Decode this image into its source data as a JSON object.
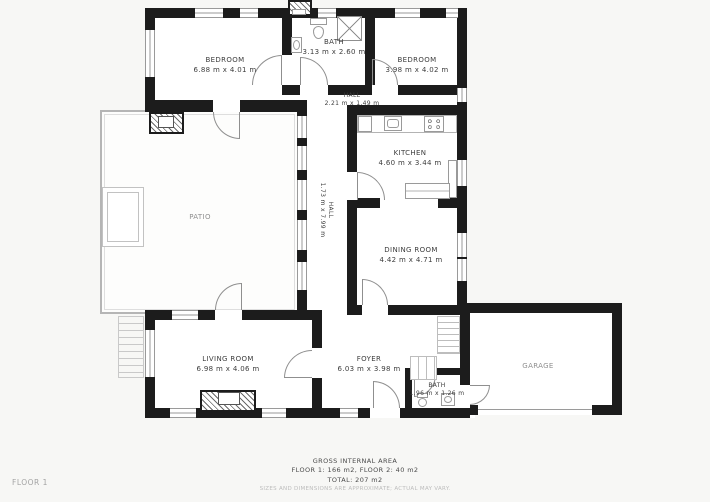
{
  "floor_label": "FLOOR 1",
  "rooms": {
    "bedroom1": {
      "name": "BEDROOM",
      "dims": "6.88 m x 4.01 m"
    },
    "bath1": {
      "name": "BATH",
      "dims": "3.13 m x 2.60 m"
    },
    "bedroom2": {
      "name": "BEDROOM",
      "dims": "3.98 m x 4.02 m"
    },
    "hall_top": {
      "name": "HALL",
      "dims": "2.21 m x 1.49 m"
    },
    "hall_corridor": {
      "name": "HALL",
      "dims": "1.73 m x 7.99 m"
    },
    "kitchen": {
      "name": "KITCHEN",
      "dims": "4.60 m x 3.44 m"
    },
    "patio": {
      "name": "PATIO"
    },
    "dining": {
      "name": "DINING ROOM",
      "dims": "4.42 m x 4.71 m"
    },
    "living": {
      "name": "LIVING ROOM",
      "dims": "6.98 m x 4.06 m"
    },
    "foyer": {
      "name": "FOYER",
      "dims": "6.03 m x 3.98 m"
    },
    "bath2": {
      "name": "BATH",
      "dims": "1.96 m x 1.26 m"
    },
    "garage": {
      "name": "GARAGE"
    }
  },
  "footer": {
    "title": "GROSS INTERNAL AREA",
    "floors": "FLOOR 1: 166 m2, FLOOR 2: 40 m2",
    "total": "TOTAL: 207 m2",
    "disclaimer": "SIZES AND DIMENSIONS ARE APPROXIMATE; ACTUAL MAY VARY."
  }
}
